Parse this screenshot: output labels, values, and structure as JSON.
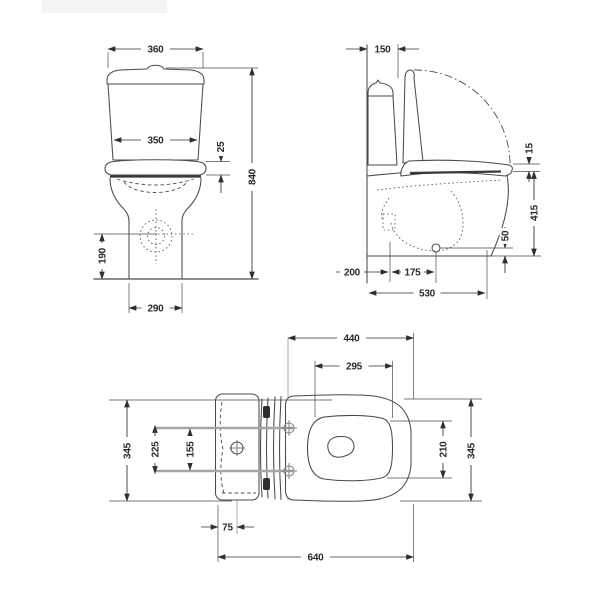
{
  "drawing": {
    "front_view": {
      "tank_width": "360",
      "tank_body_width": "350",
      "seat_overlap": "25",
      "overall_height": "840",
      "outlet_height": "190",
      "base_width": "290"
    },
    "side_view": {
      "tank_depth": "150",
      "seat_thickness": "15",
      "rim_height": "415",
      "outlet_height": "50",
      "rear_offset": "200",
      "outlet_setback": "175",
      "overall_depth": "530"
    },
    "top_view": {
      "seat_length": "440",
      "bowl_opening_length": "295",
      "overall_width_left": "345",
      "fixing_span_outer": "225",
      "fixing_span_inner": "155",
      "bowl_opening_width": "210",
      "overall_width_right": "345",
      "inlet_offset": "75",
      "overall_length": "640"
    }
  }
}
